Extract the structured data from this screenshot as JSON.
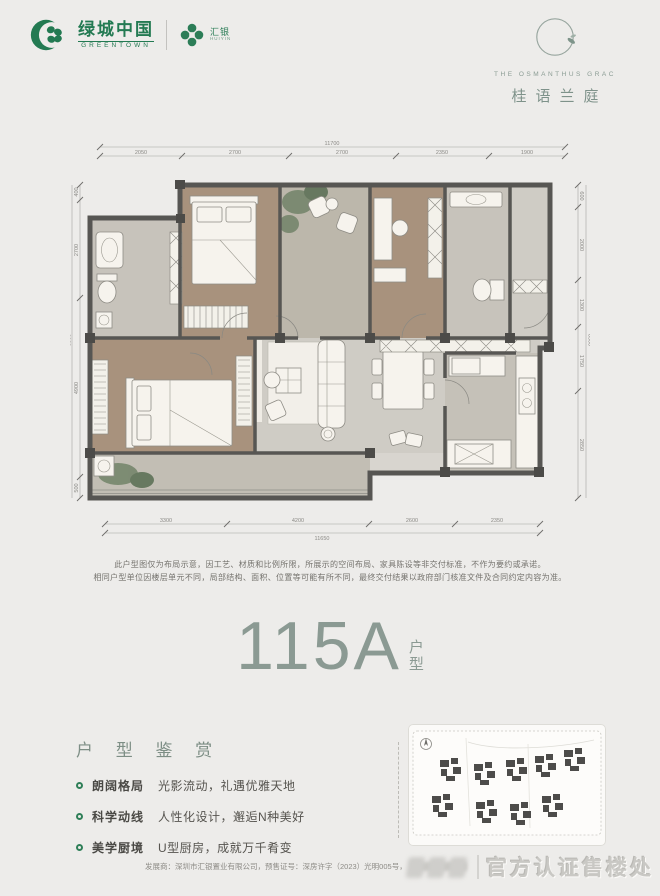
{
  "page": {
    "bg": "#edecea",
    "accent_green": "#237a52",
    "unit_color": "#8b9a93"
  },
  "header": {
    "greentown": {
      "name_cn": "绿城中国",
      "name_en": "GREENTOWN"
    },
    "huiyin": {
      "name_cn": "汇银",
      "name_en": "HUIYIN"
    },
    "project": {
      "logo_en": "THE OSMANTHUS GRAC",
      "name_cn": "桂语兰庭"
    }
  },
  "floorplan": {
    "dims_top": {
      "overall": "11700",
      "segments": [
        "2050",
        "2700",
        "2700",
        "2350",
        "1900"
      ]
    },
    "dims_bottom": {
      "overall": "11650",
      "segments": [
        "3300",
        "4200",
        "2600",
        "2350"
      ]
    },
    "dims_left": {
      "overall": "8500",
      "segments": [
        "400",
        "2700",
        "4900",
        "500"
      ]
    },
    "dims_right": {
      "overall": "8500",
      "segments": [
        "600",
        "2000",
        "1300",
        "1750",
        "2850"
      ]
    }
  },
  "disclaimer": {
    "line1": "此户型图仅为布局示意，因工艺、材质和比例所限，所展示的空间布局、家具陈设等非交付标准，不作为要约或承诺。",
    "line2": "相同户型单位因楼层单元不同，局部结构、面积、位置等可能有所不同，最终交付结果以政府部门核准文件及合同约定内容为准。"
  },
  "unit": {
    "number": "115A",
    "suffix_top": "户",
    "suffix_bottom": "型"
  },
  "appreciation": {
    "title": "户 型 鉴 赏",
    "items": [
      {
        "label": "朗阔格局",
        "desc": "光影流动，礼遇优雅天地"
      },
      {
        "label": "科学动线",
        "desc": "人性化设计，邂逅N种美好"
      },
      {
        "label": "美学厨境",
        "desc": "U型厨房，成就万千肴变"
      }
    ]
  },
  "footer": {
    "text": "发展商：深圳市汇银置业有限公司，预售证号：深房许字（2023）光明005号，"
  },
  "watermark": {
    "text": "官方认证售楼处"
  }
}
